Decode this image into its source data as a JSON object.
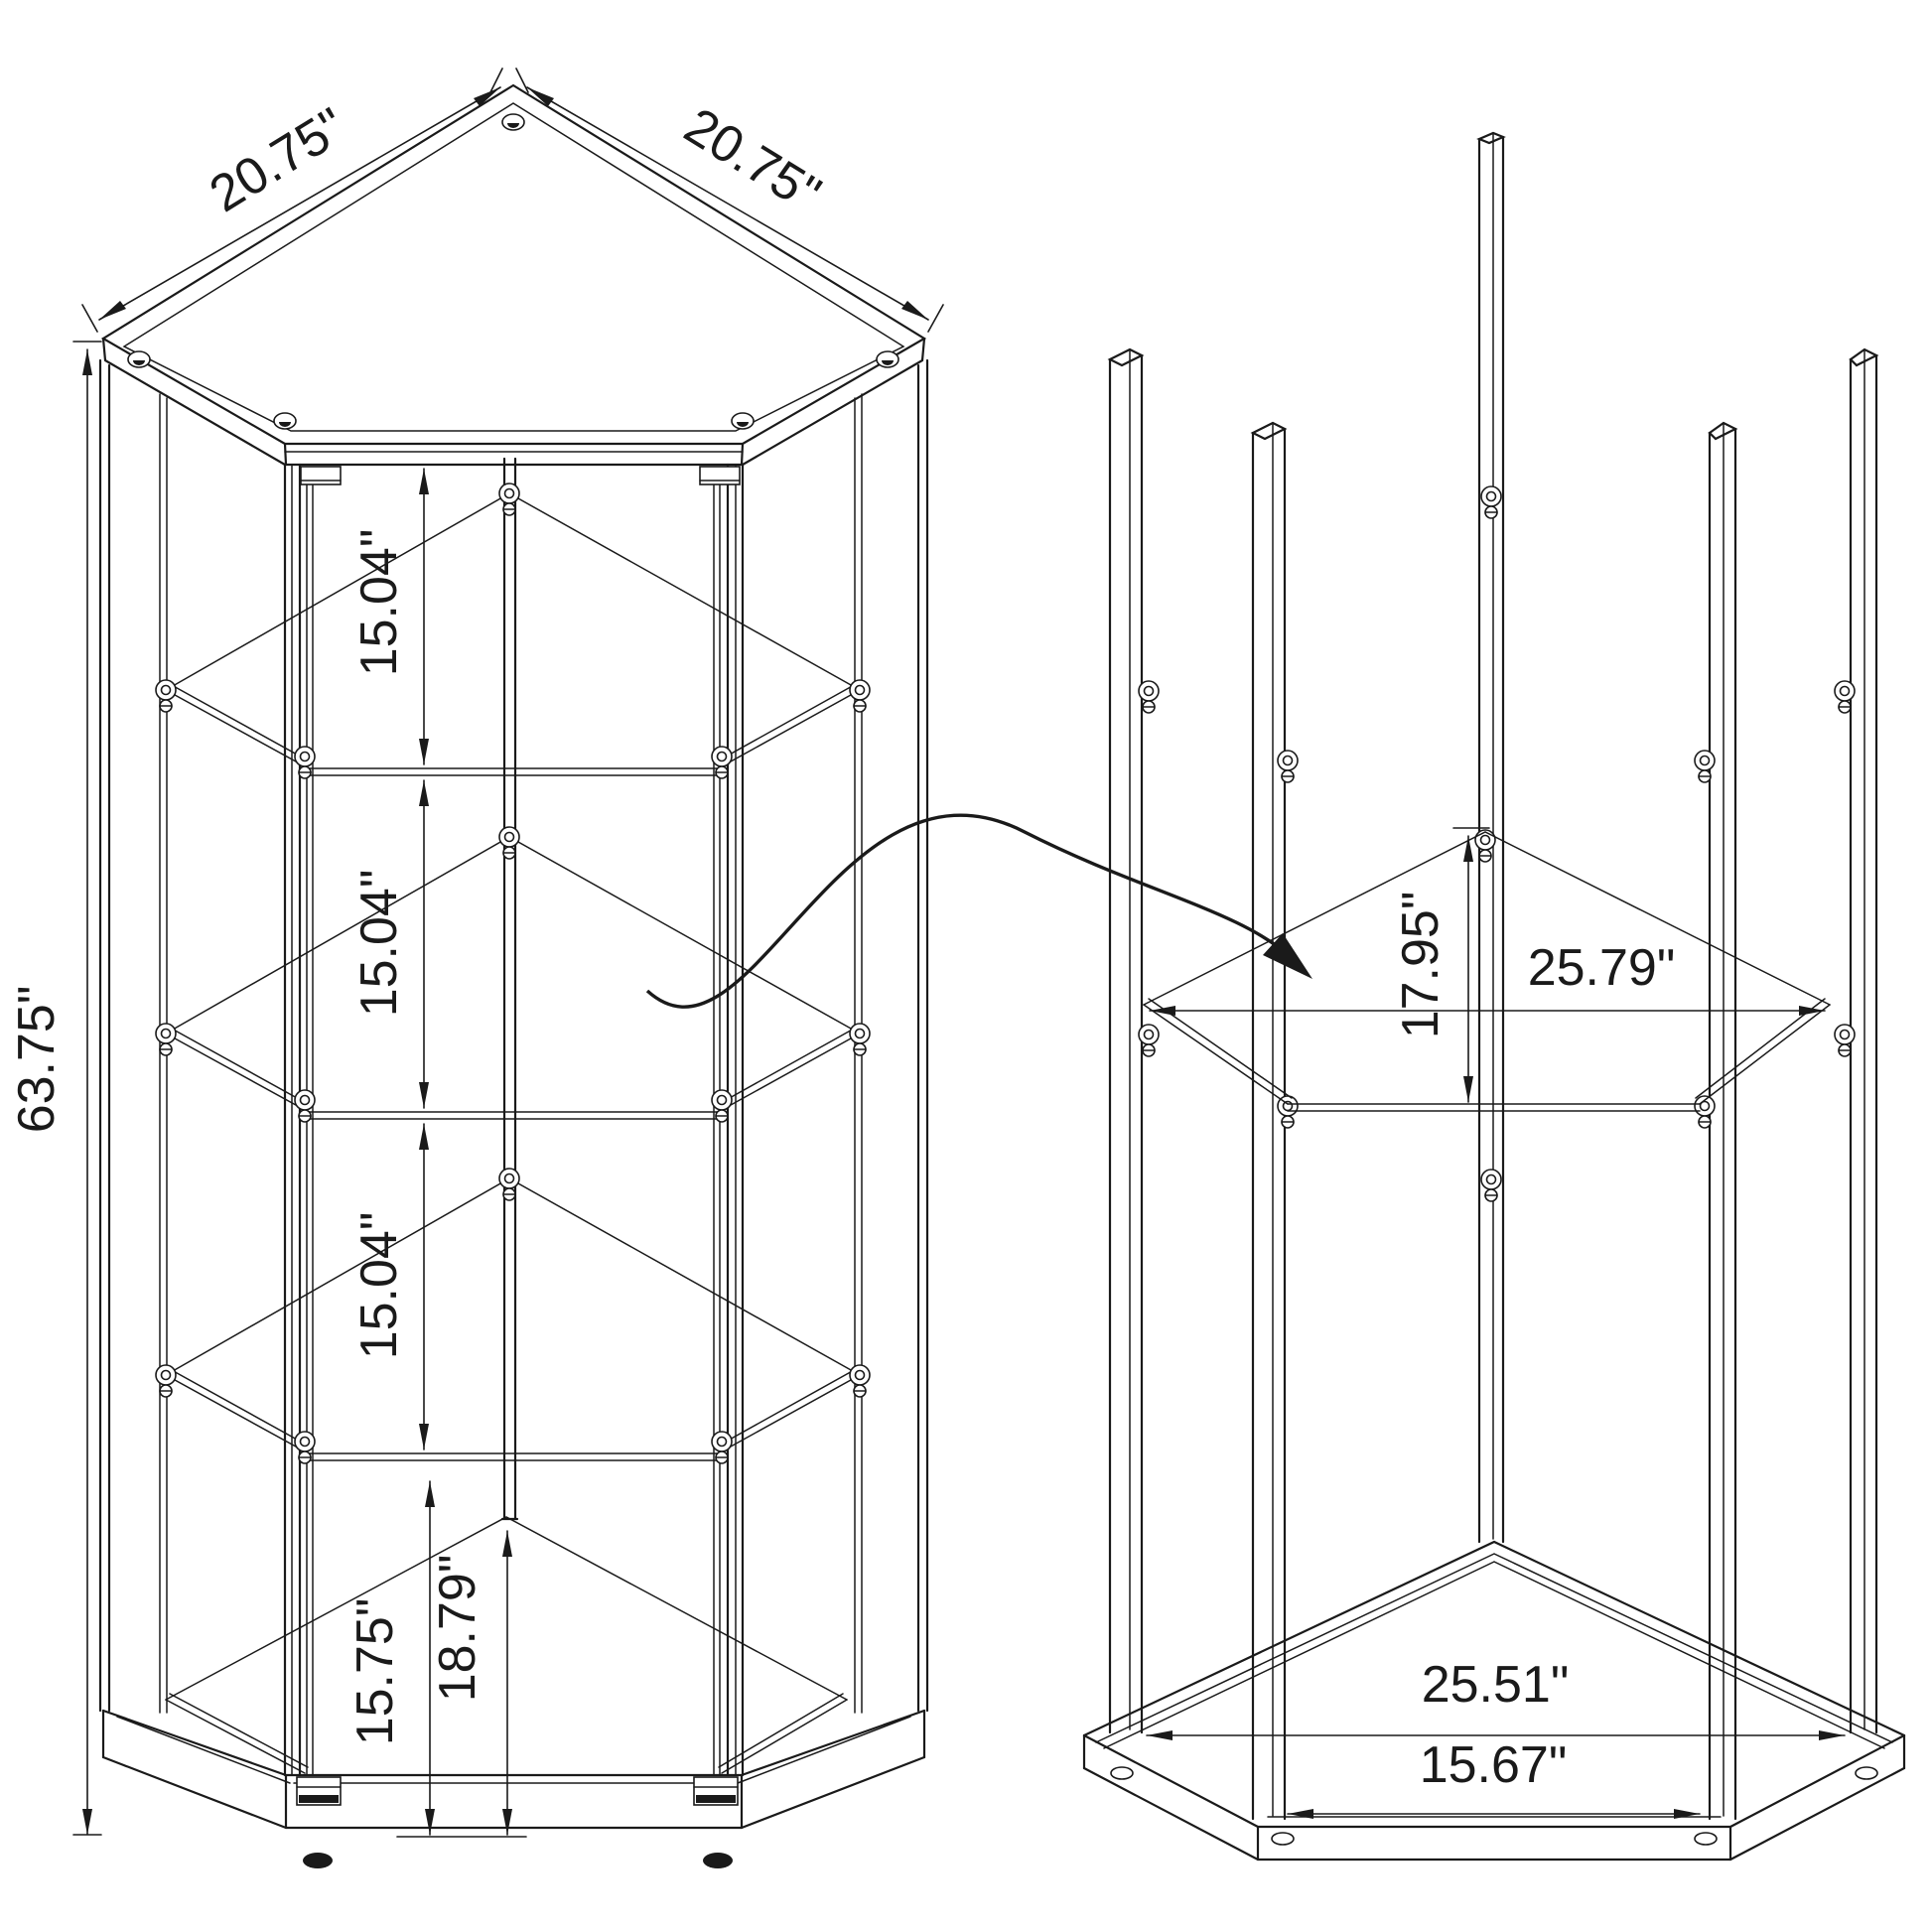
{
  "page": {
    "background": "#ffffff",
    "line_color": "#1a1a1a",
    "description": "Technical dimension drawing of a 4-shelf corner curio cabinet: assembled view (left) and exploded frame view (right) with curved assembly arrow"
  },
  "views": {
    "assembled": {
      "label": "assembled-cabinet-view",
      "dims": {
        "top_left_edge": "20.75\"",
        "top_right_edge": "20.75\"",
        "height": "63.75\"",
        "shelf_gap_1": "15.04\"",
        "shelf_gap_2": "15.04\"",
        "shelf_gap_3": "15.04\"",
        "bottom_front_height": "15.75\"",
        "bottom_center_height": "18.79\""
      }
    },
    "exploded": {
      "label": "exploded-frame-view",
      "dims": {
        "shelf_depth": "17.95\"",
        "shelf_width": "25.79\"",
        "base_width": "25.51\"",
        "base_front_width": "15.67\""
      }
    }
  }
}
